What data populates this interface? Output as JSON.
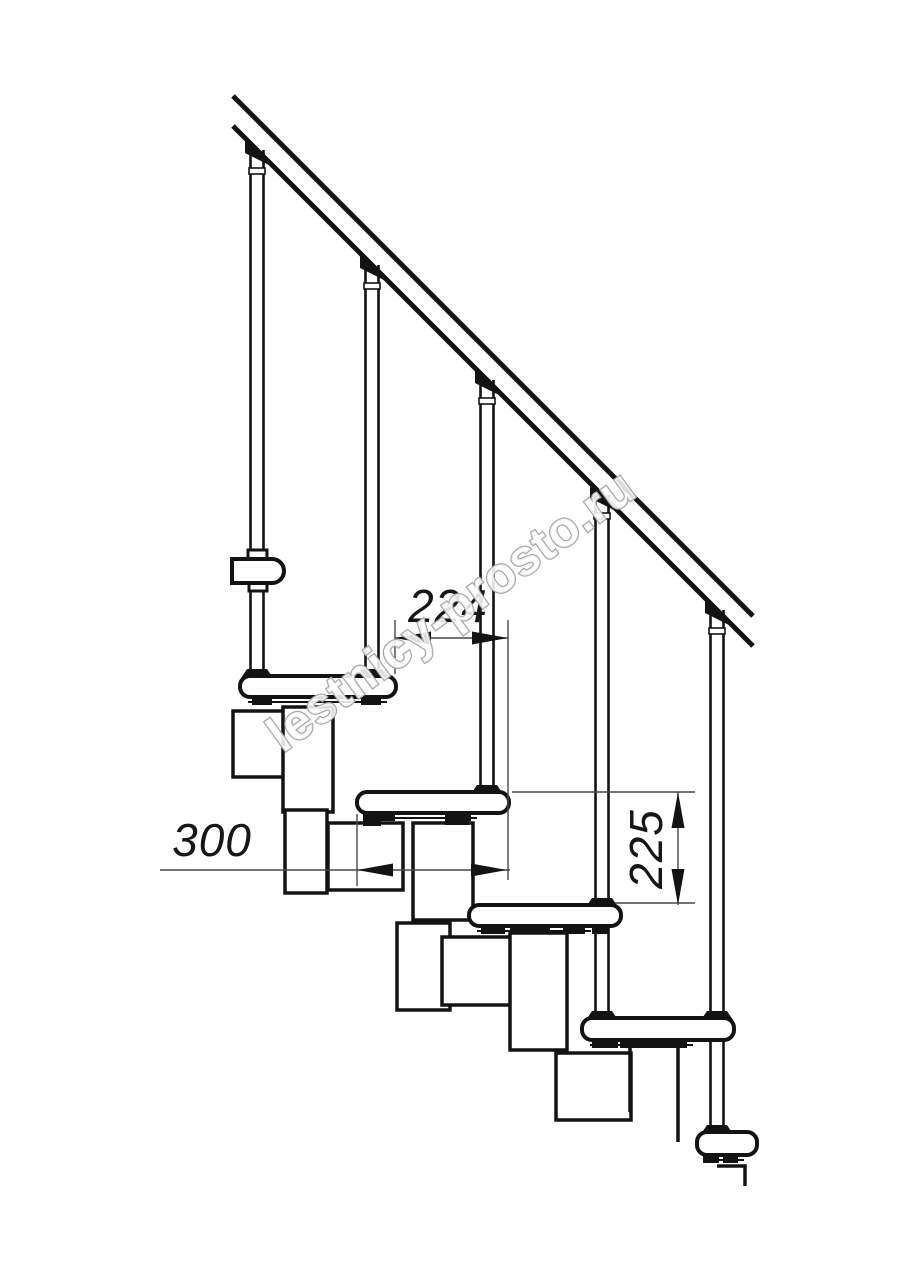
{
  "watermark": {
    "text": "lestnicy-prosto.ru",
    "color": "#a8a8a8"
  },
  "dims": {
    "going": {
      "label": "224",
      "unit": "mm"
    },
    "depth": {
      "label": "300",
      "unit": "mm"
    },
    "rise": {
      "label": "225",
      "unit": "mm"
    }
  },
  "drawing": {
    "colors": {
      "line": "#131313",
      "thin": "#474747",
      "fill": "#ffffff"
    },
    "rail": {
      "x1": 233,
      "x2": 753,
      "y_upper": 96,
      "y_lower": 126,
      "slope": 1.0,
      "stroke": 5
    },
    "balusters": [
      {
        "cx": 257,
        "bottom": 676
      },
      {
        "cx": 372,
        "bottom": 676
      },
      {
        "cx": 487,
        "bottom": 792
      },
      {
        "cx": 602,
        "bottom": 905
      },
      {
        "cx": 717,
        "bottom": 1132
      }
    ],
    "tubes": [
      {
        "cx": 602,
        "y1": 927,
        "y2": 1013
      }
    ],
    "extra_base_clamps": [
      {
        "cx": 602,
        "ty": 1018
      },
      {
        "cx": 717,
        "ty": 1018
      }
    ],
    "treads": [
      {
        "x": 240,
        "y": 676,
        "w": 156,
        "h": 21,
        "feet": [
          [
            12,
            20
          ],
          [
            121,
            20
          ]
        ]
      },
      {
        "x": 357,
        "y": 792,
        "w": 152,
        "h": 21,
        "feet": [
          [
            8,
            30
          ],
          [
            88,
            26
          ]
        ]
      },
      {
        "x": 469,
        "y": 905,
        "w": 152,
        "h": 21,
        "feet": [
          [
            12,
            24
          ],
          [
            41,
            40
          ],
          [
            94,
            22
          ]
        ]
      },
      {
        "x": 582,
        "y": 1018,
        "w": 152,
        "h": 22,
        "feet": [
          [
            10,
            26
          ],
          [
            38,
            67
          ]
        ]
      },
      {
        "x": 697,
        "y": 1132,
        "w": 60,
        "h": 23,
        "feet": [
          [
            6,
            16
          ],
          [
            26,
            15
          ]
        ]
      }
    ],
    "boxes": [
      [
        283,
        707,
        50,
        105
      ],
      [
        285,
        810,
        42,
        83
      ],
      [
        328,
        823,
        75,
        67
      ],
      [
        413,
        823,
        60,
        97
      ],
      [
        397,
        923,
        53,
        87
      ],
      [
        442,
        937,
        76,
        68
      ],
      [
        510,
        933,
        57,
        117
      ],
      [
        556,
        1053,
        75,
        67
      ]
    ],
    "open_box": {
      "x1": 630,
      "x2": 678,
      "top": 1043,
      "left_bottom": 1112,
      "right_bottom": 1142
    },
    "bridges": [
      [
        363,
        813,
        18,
        13
      ],
      [
        445,
        813,
        24,
        12
      ],
      [
        592,
        926,
        17,
        8
      ]
    ],
    "collar": {
      "x": 232,
      "y": 559,
      "w": 52,
      "h": 24,
      "r": 12,
      "tabs": [
        [
          248,
          550,
          19,
          9
        ],
        [
          249,
          583,
          18,
          8
        ]
      ]
    },
    "bracket": [
      233,
      711,
      57,
      66
    ],
    "floor": {
      "points": [
        [
          717,
          1166
        ],
        [
          745,
          1166
        ],
        [
          745,
          1186
        ]
      ]
    },
    "ext_lines": [
      [
        395,
        620,
        395,
        674
      ],
      [
        508,
        620,
        508,
        880
      ],
      [
        357,
        814,
        357,
        886
      ],
      [
        512,
        792,
        695,
        792
      ],
      [
        615,
        903,
        695,
        903
      ]
    ],
    "dim_lines": [
      [
        395,
        638,
        508,
        638
      ],
      [
        160,
        870,
        510,
        870
      ],
      [
        678,
        792,
        678,
        905
      ]
    ],
    "arrows": [
      {
        "x": 395,
        "y": 638,
        "dir": "left"
      },
      {
        "x": 508,
        "y": 638,
        "dir": "right"
      },
      {
        "x": 357,
        "y": 870,
        "dir": "left"
      },
      {
        "x": 507,
        "y": 870,
        "dir": "right"
      },
      {
        "x": 678,
        "y": 792,
        "dir": "up"
      },
      {
        "x": 678,
        "y": 905,
        "dir": "down"
      }
    ]
  }
}
